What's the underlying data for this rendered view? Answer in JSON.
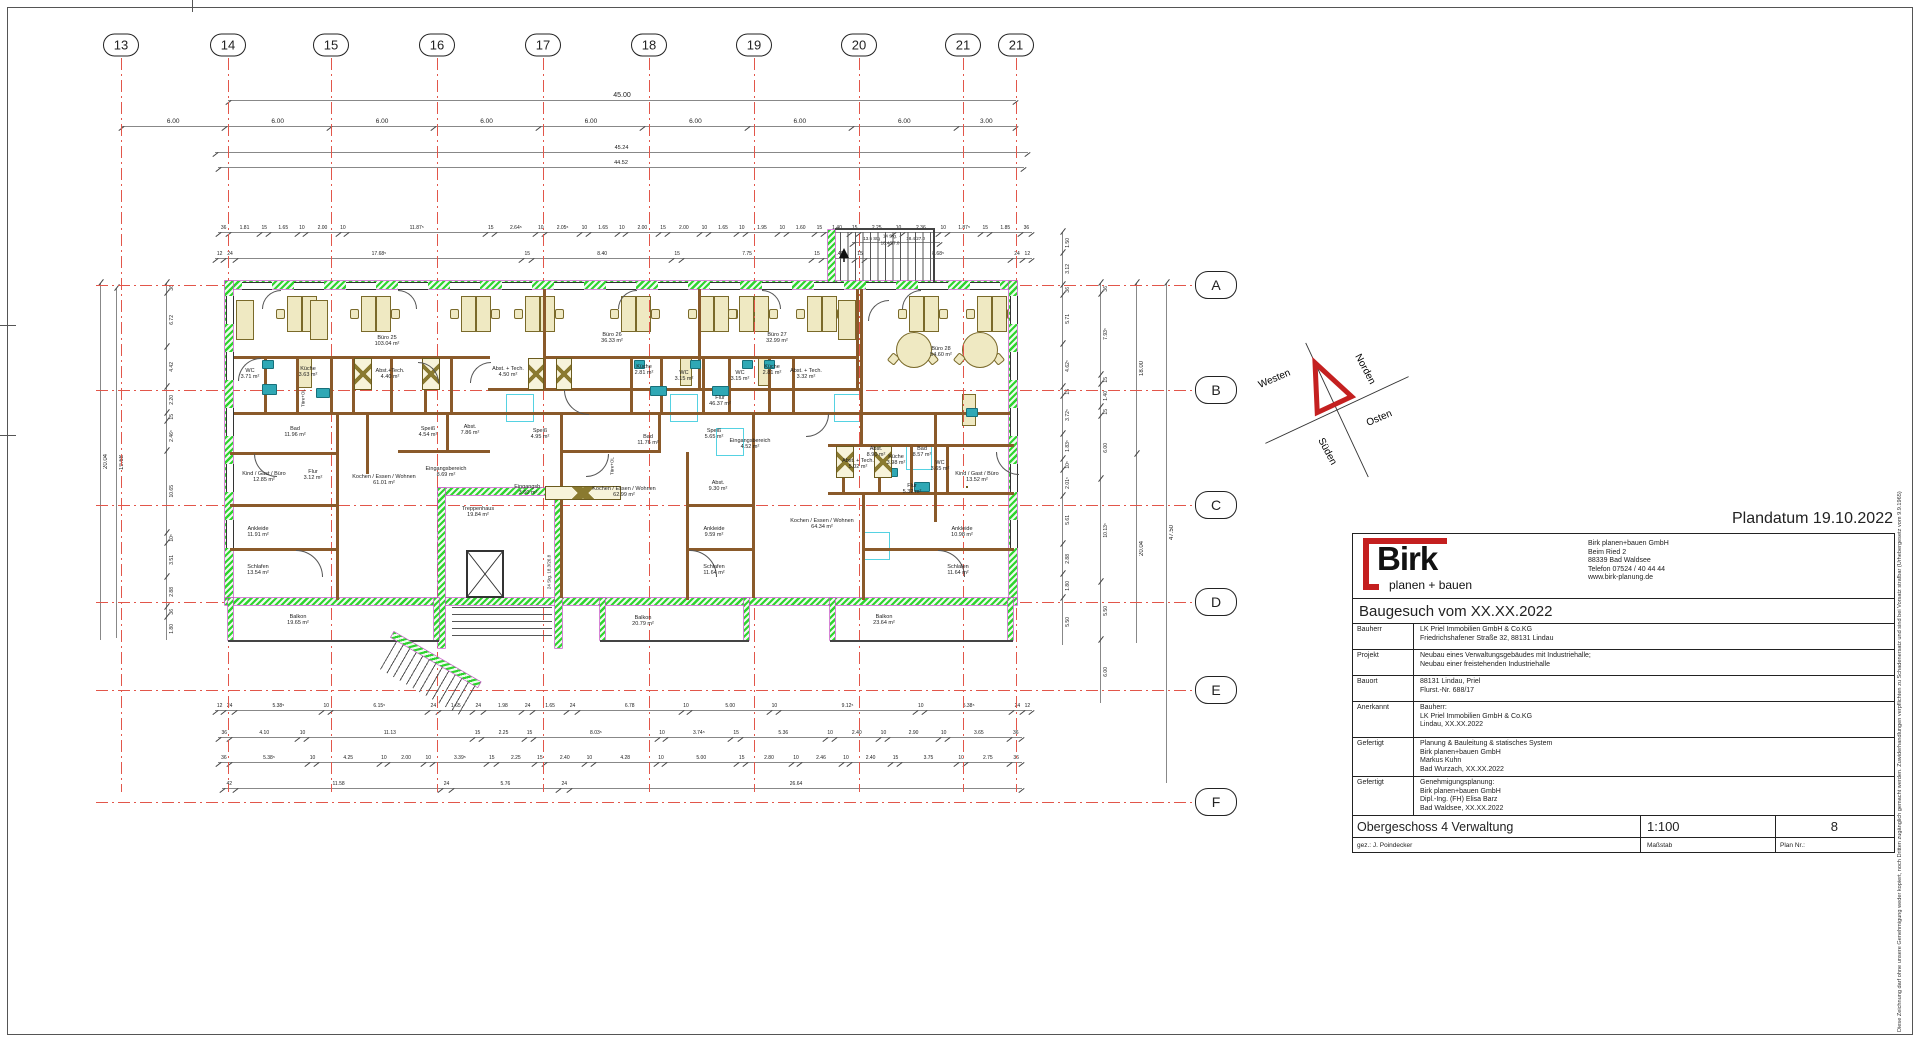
{
  "page": {
    "plandatum": "Plandatum 19.10.2022",
    "copyright": "Diese Zeichnung darf ohne unsere Genehmigung weder kopiert, noch Dritten zugänglich gemacht werden. Zuwiderhandlungen verpflichten zu Schadenersatz und sind bei Vorsatz strafbar (Urhebergesetz vom 9.9.1965)"
  },
  "logo": {
    "name": "Birk",
    "tagline": "planen + bauen",
    "address_lines": [
      "Birk planen+bauen GmbH",
      "Beim Ried 2",
      "88339 Bad Waldsee",
      "Telefon 07524 / 40 44 44",
      "www.birk-planung.de"
    ]
  },
  "titleblock": {
    "title": "Baugesuch vom XX.XX.2022",
    "rows": [
      {
        "label": "Bauherr",
        "lines": [
          "LK Priel Immobilien GmbH & Co.KG",
          "Friedrichshafener Straße 32, 88131 Lindau"
        ]
      },
      {
        "label": "Projekt",
        "lines": [
          "Neubau eines Verwaltungsgebäudes mit Industriehalle;",
          "Neubau einer freistehenden Industriehalle"
        ]
      },
      {
        "label": "Bauort",
        "lines": [
          "88131 Lindau, Priel",
          "Flurst.-Nr. 688/17"
        ]
      },
      {
        "label": "Anerkannt",
        "lines": [
          "Bauherr:",
          "LK Priel Immobilien GmbH & Co.KG",
          "Lindau, XX.XX.2022"
        ]
      },
      {
        "label": "Gefertigt",
        "lines": [
          "Planung & Bauleitung & statisches System",
          "Birk planen+bauen GmbH",
          "Markus Kuhn",
          "Bad Wurzach, XX.XX.2022"
        ]
      },
      {
        "label": "Gefertigt",
        "lines": [
          "Genehmigungsplanung:",
          "Birk planen+bauen GmbH",
          "Dipl.-Ing. (FH) Elisa Barz",
          "Bad Waldsee, XX.XX.2022"
        ]
      }
    ],
    "footer": {
      "title": "Obergeschoss 4 Verwaltung",
      "scale": "1:100",
      "plan_no": "8",
      "gez": "gez.: J. Poindecker",
      "massstab": "Maßstab",
      "plan_nr_label": "Plan Nr.:"
    }
  },
  "grid": {
    "cols": [
      {
        "label": "13",
        "x": 121
      },
      {
        "label": "14",
        "x": 228
      },
      {
        "label": "15",
        "x": 331
      },
      {
        "label": "16",
        "x": 437
      },
      {
        "label": "17",
        "x": 543
      },
      {
        "label": "18",
        "x": 649
      },
      {
        "label": "19",
        "x": 754
      },
      {
        "label": "20",
        "x": 859
      },
      {
        "label": "21",
        "x": 963
      },
      {
        "label": "21",
        "x": 1016
      }
    ],
    "rows": [
      {
        "label": "A",
        "y": 285
      },
      {
        "label": "B",
        "y": 390
      },
      {
        "label": "C",
        "y": 505
      },
      {
        "label": "D",
        "y": 602
      },
      {
        "label": "E",
        "y": 690
      },
      {
        "label": "F",
        "y": 802
      }
    ]
  },
  "dims": {
    "total_top": "45.00",
    "top_spans": [
      "6.00",
      "6.00",
      "6.00",
      "6.00",
      "6.00",
      "6.00",
      "6.00",
      "6.00",
      "3.00"
    ],
    "row_4524": "45.24",
    "row_4452": "44.52",
    "chain_t1": [
      "36",
      "1.81",
      "15",
      "1.65",
      "10",
      "2.00",
      "10",
      "11.87⁵",
      "15",
      "2.64⁵",
      "10",
      "2.05⁵",
      "10",
      "1.65",
      "10",
      "2.00",
      "15",
      "2.00",
      "10",
      "1.65",
      "10",
      "1.95",
      "10",
      "1.60",
      "15",
      "1.40",
      "15",
      "2.25",
      "10",
      "2.36",
      "10",
      "1.87⁵",
      "15",
      "1.85",
      "36"
    ],
    "chain_t2": [
      "12",
      "24",
      "17.68⁵",
      "15",
      "8.40",
      "15",
      "7.75",
      "15",
      "1.40",
      "15",
      "8.68⁵",
      "24",
      "12"
    ],
    "chain_b1": [
      "12",
      "24",
      "5.38⁵",
      "10",
      "6.15⁵",
      "24",
      "1.65",
      "24",
      "1.98",
      "24",
      "1.65",
      "24",
      "6.78",
      "10",
      "5.00",
      "10",
      "9.12⁵",
      "10",
      "5.38⁵",
      "24",
      "12"
    ],
    "chain_b2": [
      "36",
      "4.10",
      "10",
      "11.13",
      "15",
      "2.25",
      "15",
      "8.03⁵",
      "10",
      "3.74⁵",
      "15",
      "5.36",
      "10",
      "2.40",
      "10",
      "2.90",
      "10",
      "3.65",
      "36"
    ],
    "chain_b3": [
      "36",
      "5.38⁵",
      "10",
      "4.25",
      "10",
      "2.00",
      "10",
      "3.39⁵",
      "15",
      "2.25",
      "15",
      "2.40",
      "10",
      "4.28",
      "10",
      "5.00",
      "15",
      "2.80",
      "10",
      "2.46",
      "10",
      "2.40",
      "15",
      "3.75",
      "10",
      "2.75",
      "36"
    ],
    "chain_b4": [
      "42",
      "11.58",
      "24",
      "5.76",
      "24",
      "26.64"
    ],
    "left_chain": [
      "36",
      "6.72",
      "4.42",
      "2.20",
      "15",
      "2.46⁵",
      "10.65",
      "10⁵",
      "3.51",
      "2.88",
      "36",
      "1.80"
    ],
    "left_2004": "20.04",
    "left_1968": "19.68",
    "right_chain1": [
      "1.50",
      "3.12",
      "36",
      "5.71",
      "4.62⁵",
      "15",
      "3.72⁵",
      "1.83⁵",
      "10⁵",
      "2.01⁵",
      "5.61",
      "2.88",
      "1.80",
      "5.50"
    ],
    "right_chain2": [
      "36",
      "7.93⁵",
      "15",
      "1.40",
      "15",
      "6.00",
      "10.13⁵",
      "5.50",
      "6.00"
    ],
    "right_1800": "18.00",
    "right_2004": "20.04",
    "right_4750": "47.50",
    "stair_top_chain": [
      "13.5 Stg",
      "18.4/27.0"
    ]
  },
  "rooms": [
    {
      "name": "Büro 25",
      "area": "103.04 m²",
      "x": 387,
      "y": 341
    },
    {
      "name": "Büro 26",
      "area": "36.33 m²",
      "x": 612,
      "y": 338
    },
    {
      "name": "Büro 27",
      "area": "32.99 m²",
      "x": 777,
      "y": 338
    },
    {
      "name": "Büro 28",
      "area": "54.60 m²",
      "x": 941,
      "y": 352
    },
    {
      "name": "WC",
      "area": "3.71 m²",
      "x": 250,
      "y": 374
    },
    {
      "name": "Küche",
      "area": "3.63 m²",
      "x": 308,
      "y": 372
    },
    {
      "name": "Abst.+Tech.",
      "area": "4.40 m²",
      "x": 390,
      "y": 374
    },
    {
      "name": "Abst. + Tech.",
      "area": "4.50 m²",
      "x": 508,
      "y": 372
    },
    {
      "name": "Küche",
      "area": "2.81 m²",
      "x": 644,
      "y": 370
    },
    {
      "name": "WC",
      "area": "3.15 m²",
      "x": 684,
      "y": 376
    },
    {
      "name": "WC",
      "area": "3.15 m²",
      "x": 740,
      "y": 376
    },
    {
      "name": "Küche",
      "area": "2.81 m²",
      "x": 772,
      "y": 370
    },
    {
      "name": "Abst. + Tech.",
      "area": "3.32 m²",
      "x": 806,
      "y": 374
    },
    {
      "name": "Flur",
      "area": "46.37 m²",
      "x": 720,
      "y": 401
    },
    {
      "name": "Abst. + Tech.",
      "area": "5.02 m²",
      "x": 858,
      "y": 464
    },
    {
      "name": "Küche",
      "area": "3.98 m²",
      "x": 896,
      "y": 460
    },
    {
      "name": "WC",
      "area": "3.65 m²",
      "x": 940,
      "y": 466
    },
    {
      "name": "Bad",
      "area": "11.96 m²",
      "x": 295,
      "y": 432
    },
    {
      "name": "Speiß",
      "area": "4.54 m²",
      "x": 428,
      "y": 432
    },
    {
      "name": "Abst.",
      "area": "7.86 m²",
      "x": 470,
      "y": 430
    },
    {
      "name": "Speiß",
      "area": "4.95 m²",
      "x": 540,
      "y": 434
    },
    {
      "name": "Bad",
      "area": "11.76 m²",
      "x": 648,
      "y": 440
    },
    {
      "name": "Speiß",
      "area": "5.65 m²",
      "x": 714,
      "y": 434
    },
    {
      "name": "Eingangsbereich",
      "area": "4.52 m²",
      "x": 750,
      "y": 444
    },
    {
      "name": "Abst.",
      "area": "8.90 m²",
      "x": 876,
      "y": 452
    },
    {
      "name": "Bad",
      "area": "8.57 m²",
      "x": 922,
      "y": 452
    },
    {
      "name": "Kind / Gast / Büro",
      "area": "12.85 m²",
      "x": 264,
      "y": 477
    },
    {
      "name": "Flur",
      "area": "3.12 m²",
      "x": 313,
      "y": 475
    },
    {
      "name": "Kochen / Essen / Wohnen",
      "area": "61.01 m²",
      "x": 384,
      "y": 480
    },
    {
      "name": "Eingangsbereich",
      "area": "8.69 m²",
      "x": 446,
      "y": 472
    },
    {
      "name": "Eingangsb.",
      "area": "3.60 m²",
      "x": 528,
      "y": 490
    },
    {
      "name": "Kochen / Essen / Wohnen",
      "area": "62.99 m²",
      "x": 624,
      "y": 492
    },
    {
      "name": "Abst.",
      "area": "9.30 m²",
      "x": 718,
      "y": 486
    },
    {
      "name": "Flur",
      "area": "5.32 m²",
      "x": 912,
      "y": 489
    },
    {
      "name": "Kind / Gast / Büro",
      "area": "13.52 m²",
      "x": 977,
      "y": 477
    },
    {
      "name": "Treppenhaus",
      "area": "19.84 m²",
      "x": 478,
      "y": 512
    },
    {
      "name": "Ankleide",
      "area": "11.91 m²",
      "x": 258,
      "y": 532
    },
    {
      "name": "Ankleide",
      "area": "9.59 m²",
      "x": 714,
      "y": 532
    },
    {
      "name": "Kochen / Essen / Wohnen",
      "area": "64.34 m²",
      "x": 822,
      "y": 524
    },
    {
      "name": "Ankleide",
      "area": "10.98 m²",
      "x": 962,
      "y": 532
    },
    {
      "name": "Schlafen",
      "area": "13.54 m²",
      "x": 258,
      "y": 570
    },
    {
      "name": "Schlafen",
      "area": "11.64 m²",
      "x": 714,
      "y": 570
    },
    {
      "name": "Schlafen",
      "area": "11.64 m²",
      "x": 958,
      "y": 570
    },
    {
      "name": "Balkon",
      "area": "19.65 m²",
      "x": 298,
      "y": 620
    },
    {
      "name": "Balkon",
      "area": "20.79 m²",
      "x": 643,
      "y": 621
    },
    {
      "name": "Balkon",
      "area": "23.64 m²",
      "x": 884,
      "y": 620
    }
  ],
  "annotations": [
    {
      "text": "14 Stg.",
      "x": 890,
      "y": 236,
      "rot": 0
    },
    {
      "text": "18.4/27.0",
      "x": 890,
      "y": 243,
      "rot": 0
    },
    {
      "text": "24 Stg. 18.3/26.8",
      "x": 549,
      "y": 572,
      "rot": -90
    },
    {
      "text": "Türe+OL",
      "x": 303,
      "y": 398,
      "rot": -90
    },
    {
      "text": "Türe+OL",
      "x": 612,
      "y": 466,
      "rot": -90
    }
  ],
  "compass": {
    "n": "Norden",
    "o": "Osten",
    "s": "Süden",
    "w": "Westen"
  },
  "colors": {
    "grid_red": "#e2564a",
    "wall_green": "#2fd42f",
    "wall_brown": "#8a5a2a",
    "furniture": "#efe9c2",
    "fixture_teal": "#2fa8b5",
    "cyan": "#55d2e2",
    "logo_red": "#c41f1f"
  }
}
